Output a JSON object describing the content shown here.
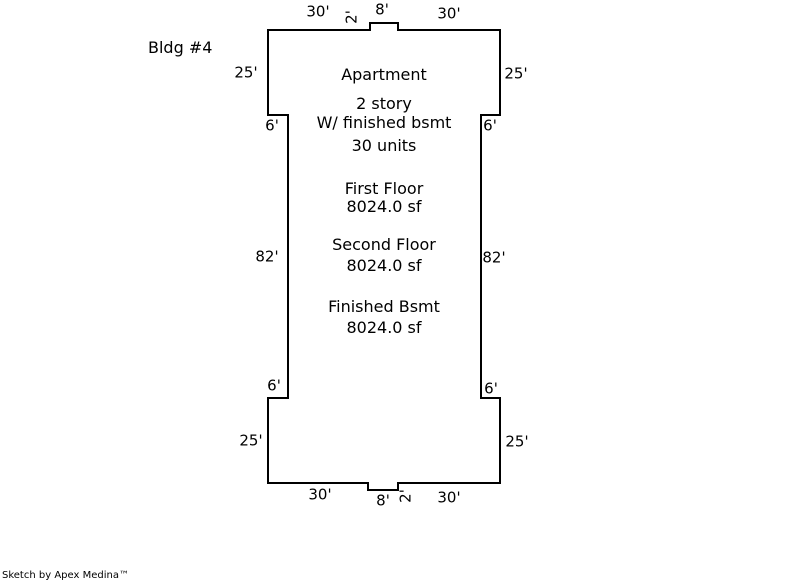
{
  "page": {
    "background": "#ffffff",
    "ink": "#000000"
  },
  "title": "Bldg #4",
  "building": {
    "name": "Apartment",
    "stories": "2 story",
    "basement_note": "W/ finished bsmt",
    "units": "30 units",
    "areas": [
      {
        "label": "First Floor",
        "value": "8024.0 sf"
      },
      {
        "label": "Second Floor",
        "value": "8024.0 sf"
      },
      {
        "label": "Finished Bsmt",
        "value": "8024.0 sf"
      }
    ]
  },
  "dimensions": {
    "top_left": "30'",
    "top_jog_depth": "2'",
    "top_jog_width": "8'",
    "top_right": "30'",
    "upper_left_side": "25'",
    "upper_right_side": "25'",
    "upper_left_step": "6'",
    "upper_right_step": "6'",
    "left_side": "82'",
    "right_side": "82'",
    "lower_left_step": "6'",
    "lower_right_step": "6'",
    "lower_left_side": "25'",
    "lower_right_side": "25'",
    "bottom_left": "30'",
    "bottom_jog_width": "8'",
    "bottom_jog_depth": "2'",
    "bottom_right": "30'"
  },
  "watermark": "Sketch by Apex Medina™"
}
